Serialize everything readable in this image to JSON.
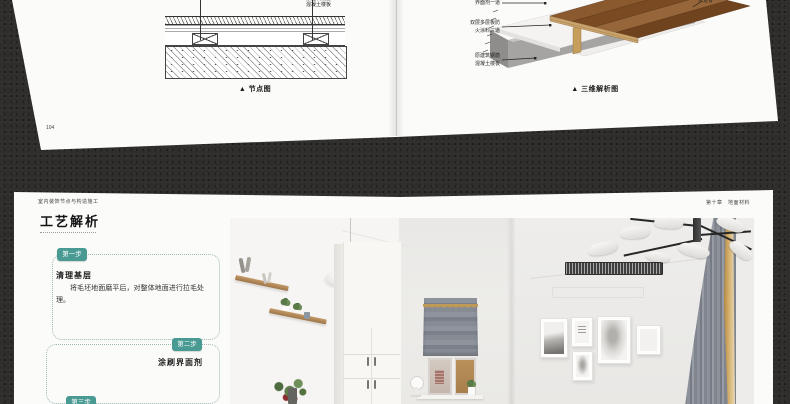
{
  "book": {
    "top_spread": {
      "left_page": {
        "page_number": "104",
        "caption": "▲ 节点图",
        "slab_label_line1": "原建筑钢筋",
        "slab_label_line2": "混凝土楼板"
      },
      "right_page": {
        "page_number": "105",
        "caption": "▲ 三维解析图",
        "label_interface": "界面剂一道",
        "label_fireboard_line1": "双层多层板防",
        "label_fireboard_line2": "火涂料三道",
        "label_slab_line1": "原建筑钢筋",
        "label_slab_line2": "混凝土楼板",
        "label_keel": "木龙骨"
      }
    },
    "bottom_spread": {
      "left_page": {
        "running_header": "室内装饰节点与构造施工",
        "title": "工艺解析",
        "step1": {
          "badge": "第一步",
          "heading": "清理基层",
          "body": "将毛坯地面磨平后，对整体地面进行拉毛处理。"
        },
        "step2": {
          "badge": "第二步",
          "heading": "涂刷界面剂"
        },
        "step3": {
          "badge": "第三步"
        }
      },
      "right_page": {
        "running_header": "第十章　地面材料"
      }
    },
    "colors": {
      "accent_teal": "#4a9a94",
      "background": "#2d2d2d",
      "page_white": "#fbfbfa",
      "curtain_gold": "#c9a261"
    }
  }
}
